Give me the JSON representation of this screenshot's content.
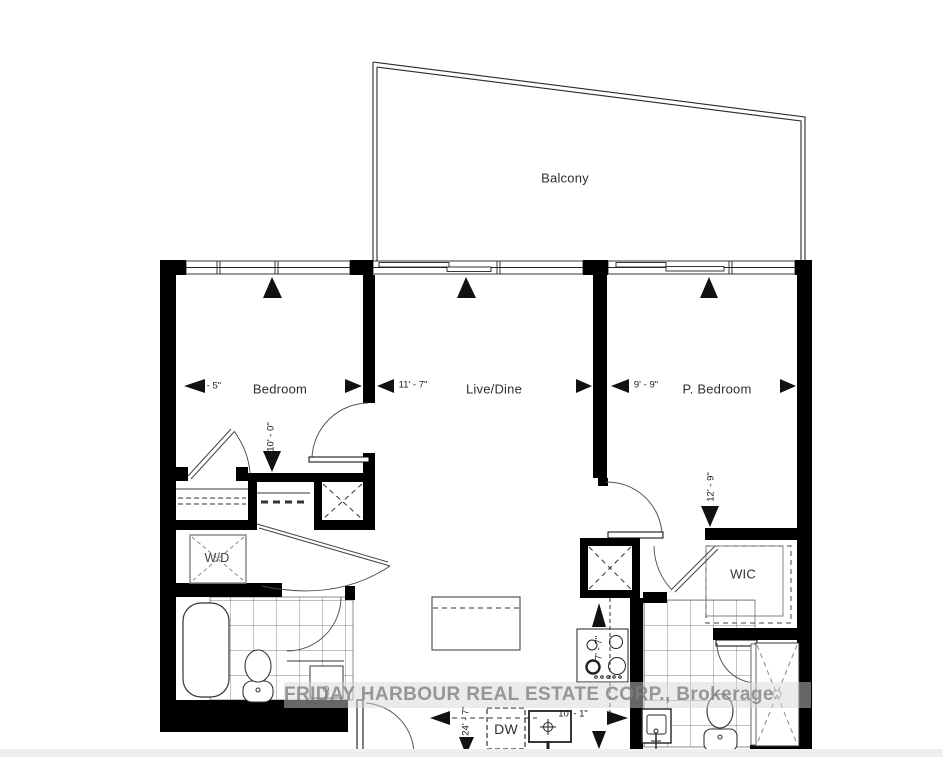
{
  "rooms": {
    "balcony": {
      "label": "Balcony"
    },
    "bedroom": {
      "label": "Bedroom"
    },
    "live_dine": {
      "label": "Live/Dine"
    },
    "p_bedroom": {
      "label": "P. Bedroom"
    },
    "wic": {
      "label": "WIC"
    },
    "washer_dryer": {
      "label": "W/D"
    },
    "dishwasher": {
      "label": "DW"
    }
  },
  "dimensions": {
    "bedroom_width": "9' - 5\"",
    "bedroom_depth": "10' - 0\"",
    "live_dine_width": "11' - 7\"",
    "p_bedroom_width": "9' - 9\"",
    "p_bedroom_depth": "12' - 9\"",
    "kitchen_depth": "7' - 7\"",
    "unit_depth": "24' - 7\"",
    "kitchen_width": "10' - 1\""
  },
  "watermark": {
    "text": "FRIDAY HARBOUR REAL ESTATE CORP., Brokerage"
  },
  "colors": {
    "wall": "#000000",
    "line": "#333333",
    "tile": "#555555",
    "label": "#2e2e2e",
    "watermark_text": "#7e7e7e",
    "footer_strip": "#efefef"
  }
}
